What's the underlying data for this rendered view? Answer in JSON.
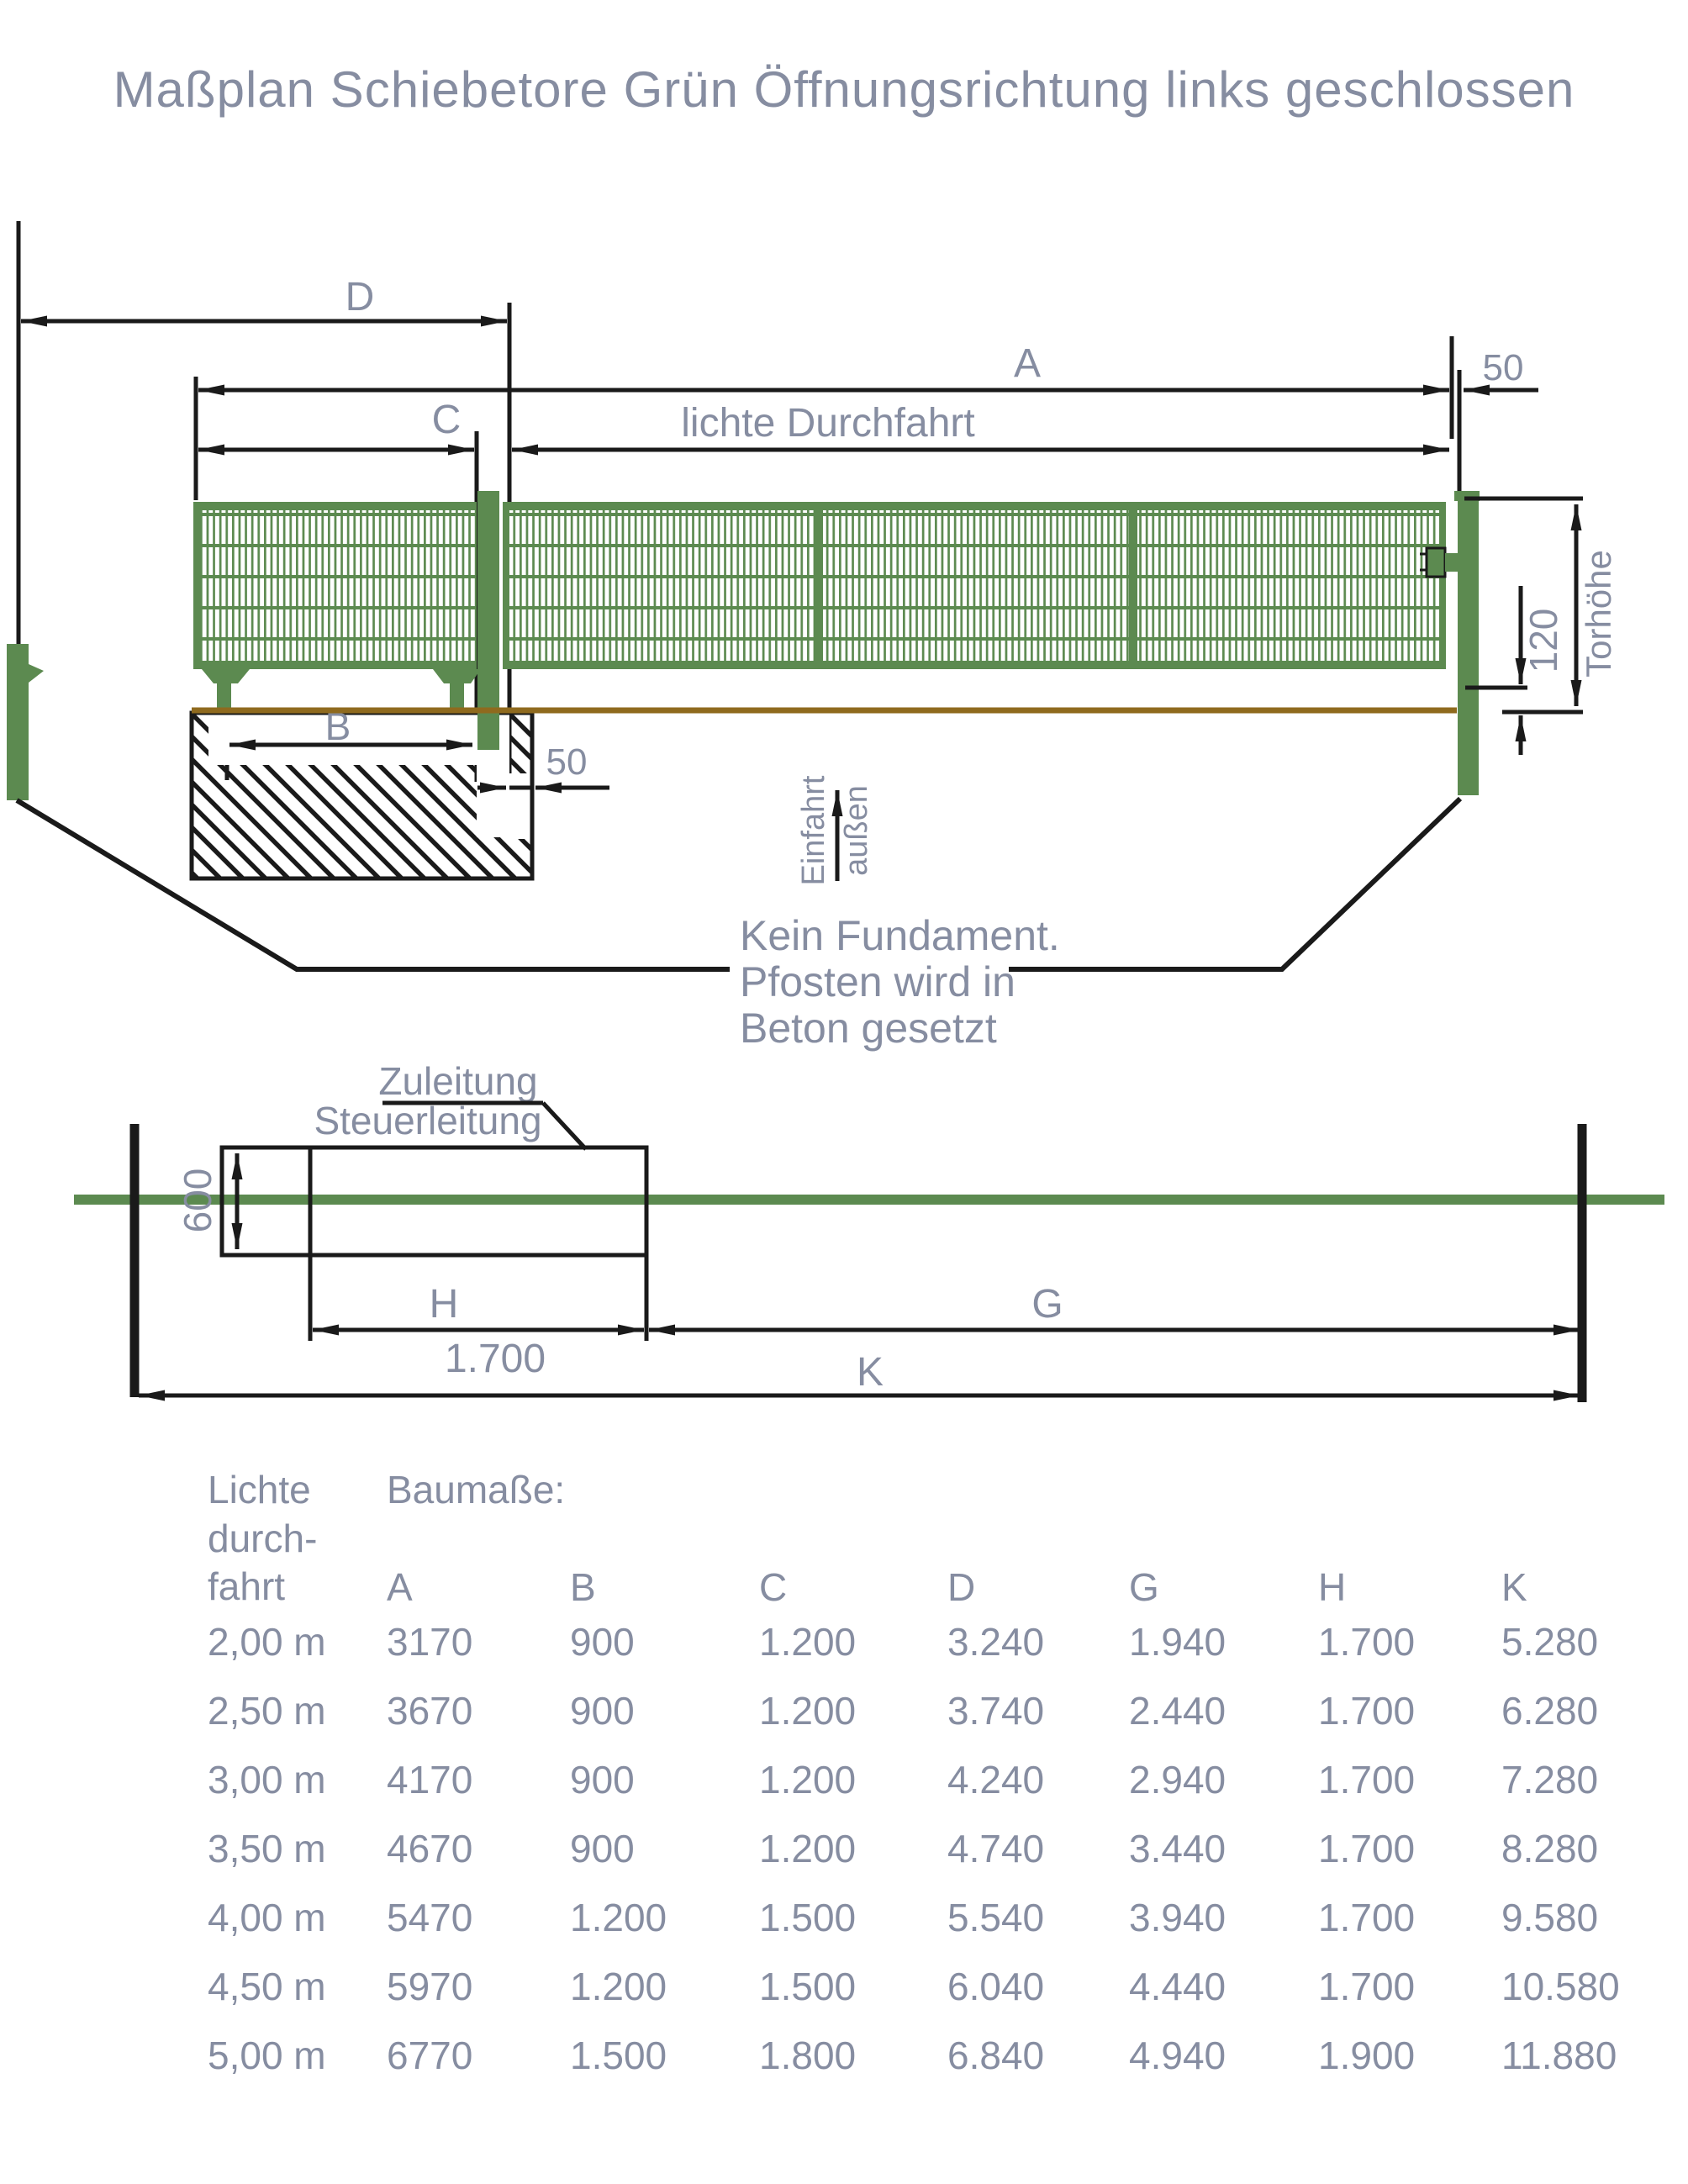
{
  "title": "Maßplan Schiebetore Grün Öffnungsrichtung links geschlossen",
  "colors": {
    "gate_green": "#5c8a50",
    "ground_brown": "#8f6a1e",
    "label_gray": "#868da1",
    "line_black": "#1a1a1a"
  },
  "elevation": {
    "dims": {
      "d": "D",
      "a": "A",
      "c": "C",
      "lichte": "lichte Durchfahrt",
      "gap_top": "50",
      "b": "B",
      "gap_foundation": "50",
      "bottom_offset": "120",
      "gate_height": "Torhöhe"
    },
    "direction": {
      "left": "Einfahrt",
      "right": "außen"
    },
    "note": [
      "Kein Fundament.",
      "Pfosten wird in",
      "Beton gesetzt"
    ]
  },
  "plan": {
    "cable1": "Zuleitung",
    "cable2": "Steuerleitung",
    "depth": "600",
    "h": "H",
    "h_value": "1.700",
    "g": "G",
    "k": "K"
  },
  "table": {
    "row_header": [
      "Lichte",
      "durch-",
      "fahrt"
    ],
    "group_header": "Baumaße:",
    "columns": [
      "A",
      "B",
      "C",
      "D",
      "G",
      "H",
      "K"
    ],
    "rows": [
      {
        "width": "2,00 m",
        "values": [
          "3170",
          "900",
          "1.200",
          "3.240",
          "1.940",
          "1.700",
          "5.280"
        ]
      },
      {
        "width": "2,50 m",
        "values": [
          "3670",
          "900",
          "1.200",
          "3.740",
          "2.440",
          "1.700",
          "6.280"
        ]
      },
      {
        "width": "3,00 m",
        "values": [
          "4170",
          "900",
          "1.200",
          "4.240",
          "2.940",
          "1.700",
          "7.280"
        ]
      },
      {
        "width": "3,50 m",
        "values": [
          "4670",
          "900",
          "1.200",
          "4.740",
          "3.440",
          "1.700",
          "8.280"
        ]
      },
      {
        "width": "4,00 m",
        "values": [
          "5470",
          "1.200",
          "1.500",
          "5.540",
          "3.940",
          "1.700",
          "9.580"
        ]
      },
      {
        "width": "4,50 m",
        "values": [
          "5970",
          "1.200",
          "1.500",
          "6.040",
          "4.440",
          "1.700",
          "10.580"
        ]
      },
      {
        "width": "5,00 m",
        "values": [
          "6770",
          "1.500",
          "1.800",
          "6.840",
          "4.940",
          "1.900",
          "11.880"
        ]
      }
    ]
  }
}
